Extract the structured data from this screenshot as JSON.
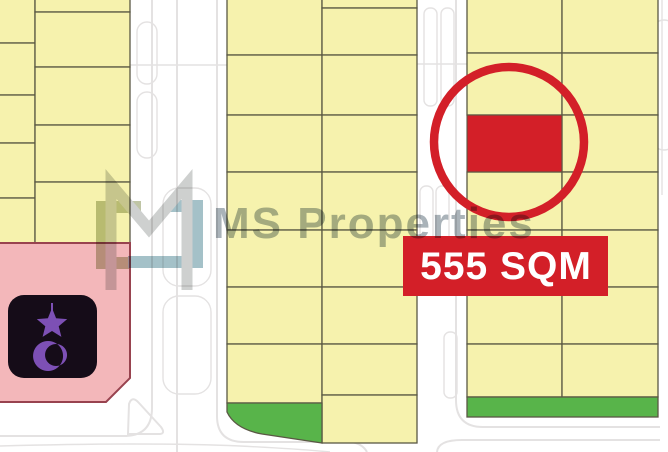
{
  "watermark": {
    "brand_text": "MS Properties",
    "logo": "ms-monogram-logo"
  },
  "highlight": {
    "label": "555 SQM",
    "marker": "red-circle-around-red-plot"
  },
  "icons": {
    "mosque": "star-and-crescent-icon"
  },
  "colors": {
    "plot_yellow": "#f6f2ad",
    "plot_border": "#5a5844",
    "highlight_red": "#d31f28",
    "label_text": "#ffffff",
    "pink_fill": "#f3b7ba",
    "pink_border": "#98434f",
    "green_fill": "#58b44a",
    "road_line": "#e4e2e2",
    "icon_bg": "#150c18",
    "icon_purple": "#7d50b5",
    "watermark_text": "#8d9aa1",
    "logo_gray": "#bdc0bf",
    "logo_teal": "#86acb6",
    "logo_olive": "#a9b287"
  }
}
